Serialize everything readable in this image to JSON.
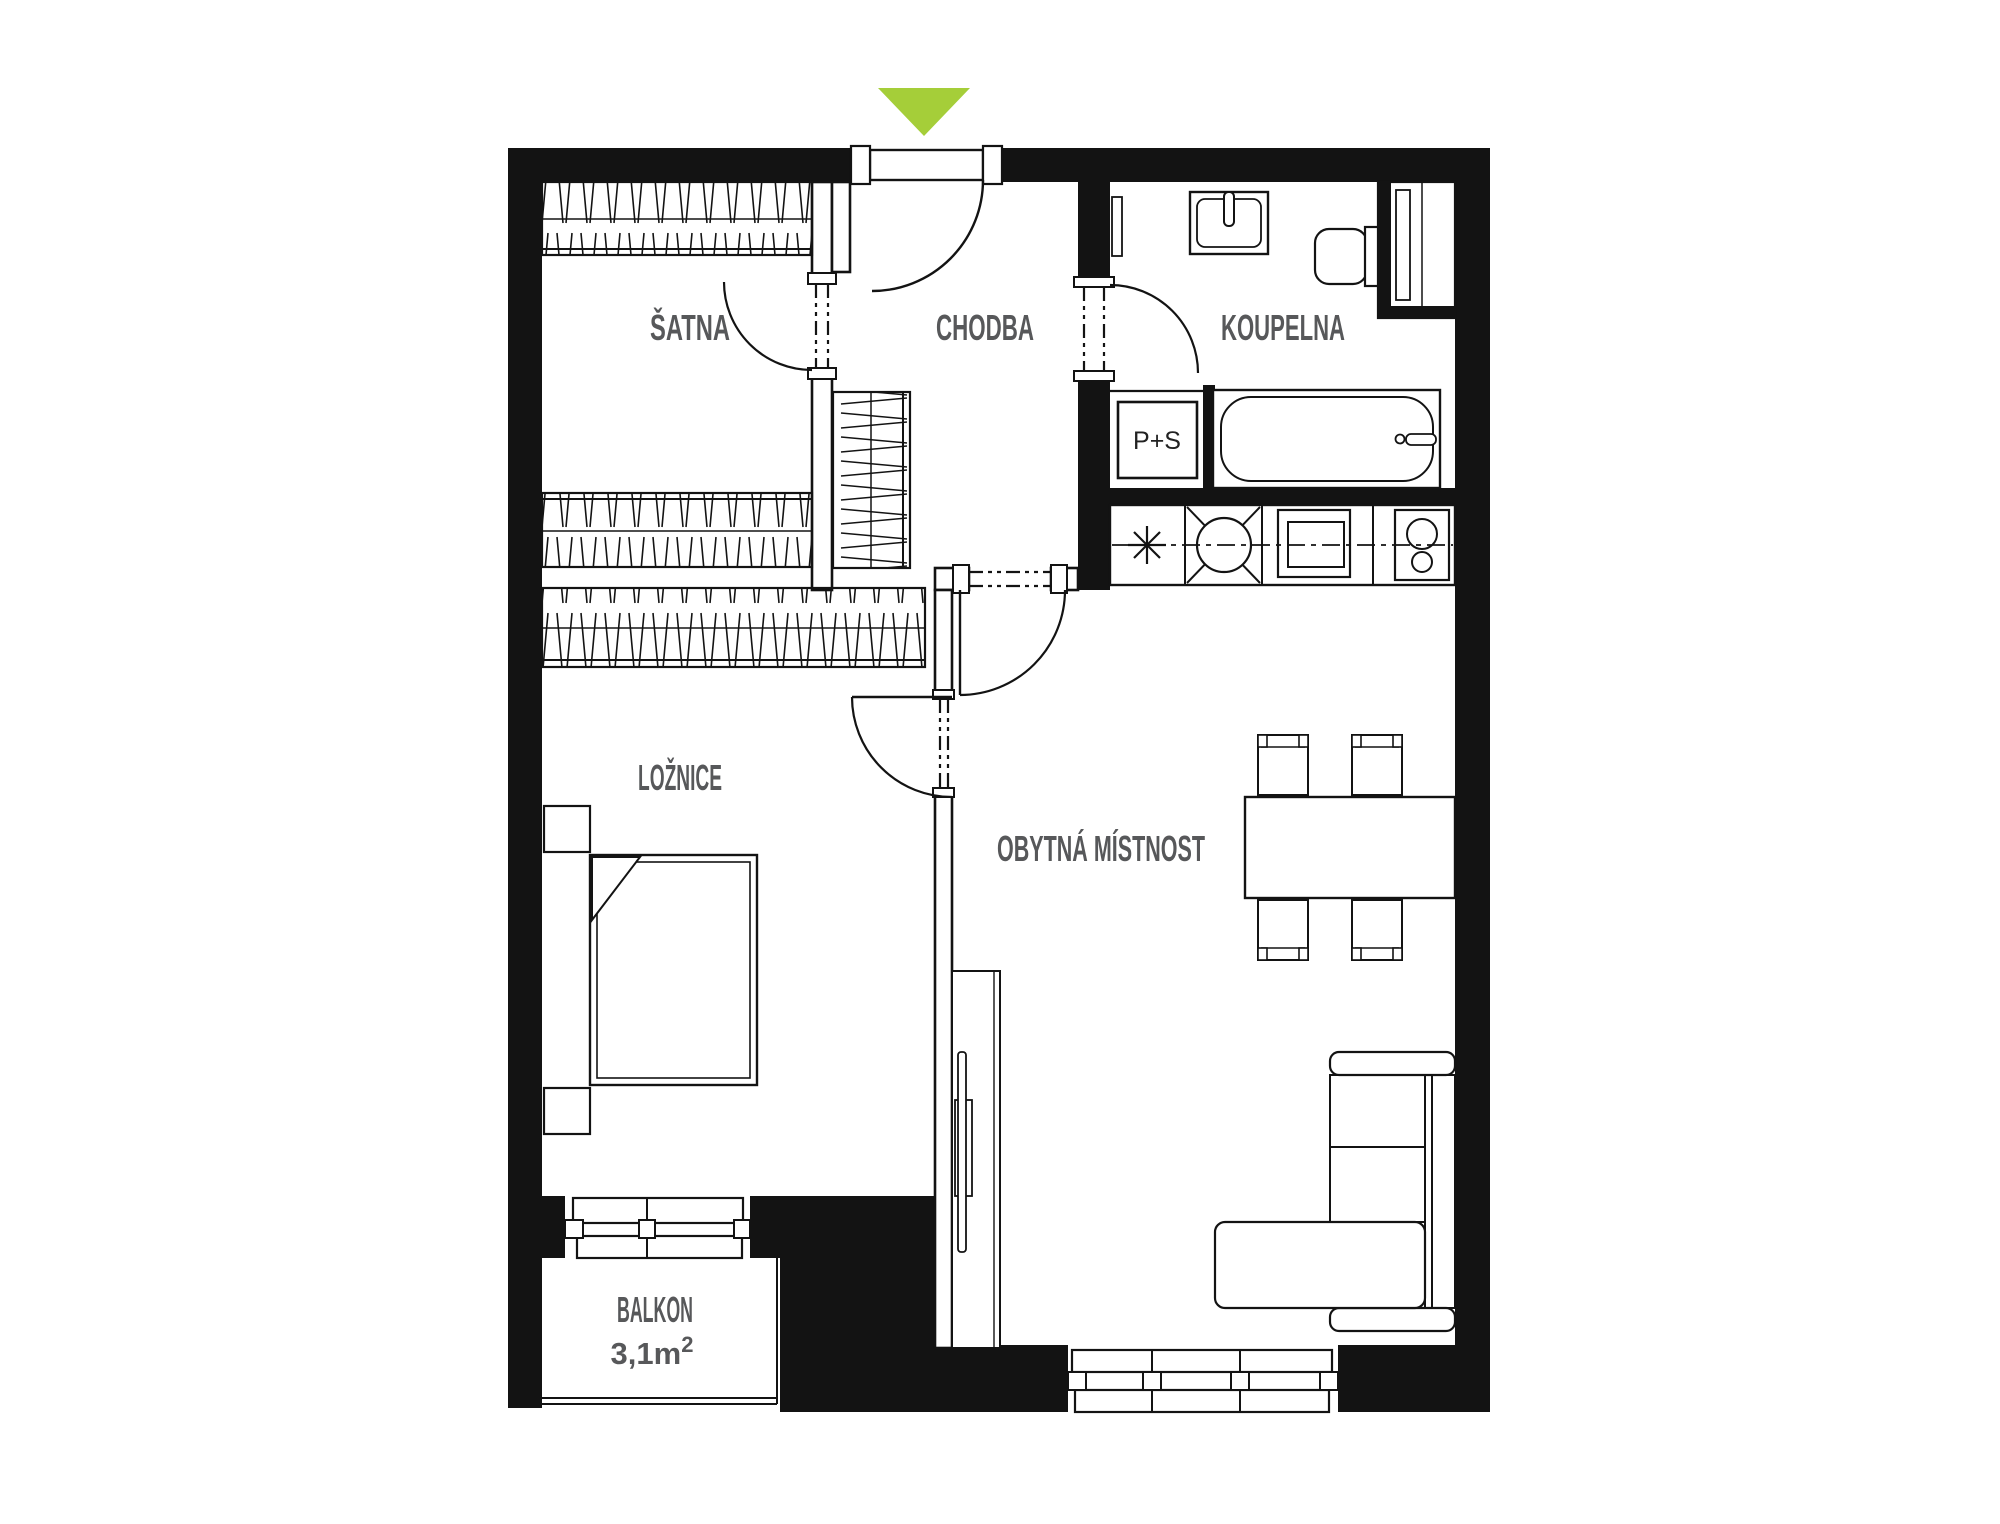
{
  "floorplan": {
    "rooms": {
      "satna": "ŠATNA",
      "chodba": "CHODBA",
      "koupelna": "KOUPELNA",
      "loznice": "LOŽNICE",
      "obytna": "OBYTNÁ MÍSTNOST",
      "balkon": "BALKON",
      "balkon_area": "3,1m",
      "balkon_area_sup": "2"
    },
    "appliances": {
      "washer_dryer": "P+S"
    },
    "icons": {
      "entry_arrow": "entrance-direction-arrow",
      "fridge_symbol": "asterisk-appliance-symbol"
    },
    "colors": {
      "entry_arrow": "#a5ce39",
      "label": "#57585a",
      "wall": "#131313",
      "background": "#ffffff"
    }
  }
}
